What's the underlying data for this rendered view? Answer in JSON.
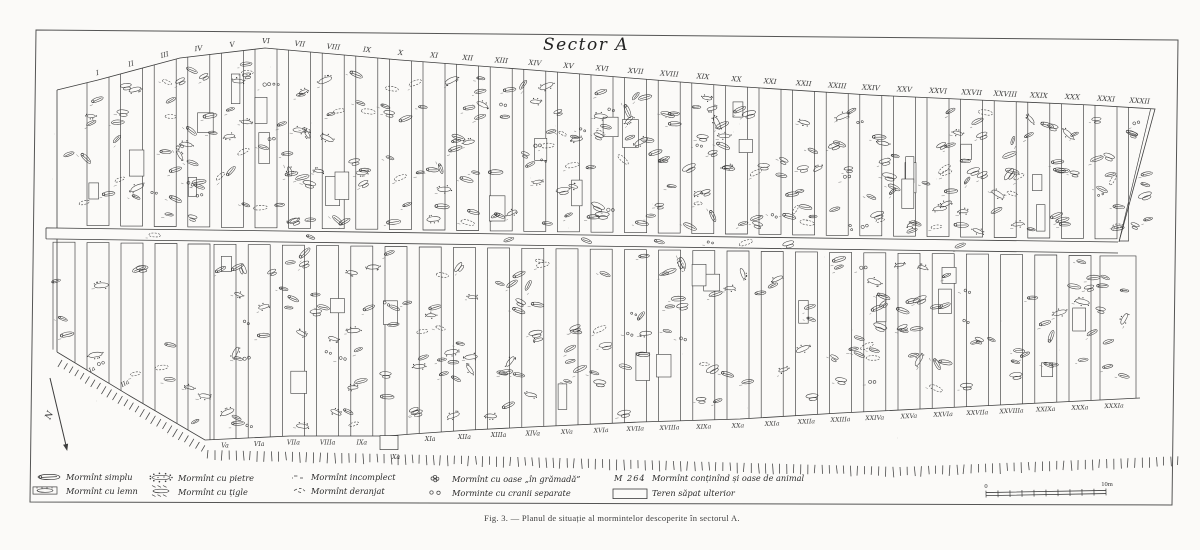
{
  "figure": {
    "title": "Sector A",
    "caption": "Fig. 3. — Planul de situație al mormintelor descoperite în sectorul A.",
    "north_label": "N"
  },
  "scale_bar": {
    "start_label": "0",
    "end_label": "10m"
  },
  "trench_labels": {
    "top": [
      "I",
      "II",
      "III",
      "IV",
      "V",
      "VI",
      "VII",
      "VIII",
      "IX",
      "X",
      "XI",
      "XII",
      "XIII",
      "XIV",
      "XV",
      "XVI",
      "XVII",
      "XVIII",
      "XIX",
      "XX",
      "XXI",
      "XXII",
      "XXIII",
      "XXIV",
      "XXV",
      "XXVI",
      "XXVII",
      "XXVIII",
      "XXIX",
      "XXX",
      "XXXI",
      "XXXII"
    ],
    "bottom_slope": [
      "Ia",
      "IIa"
    ],
    "bottom": [
      "Va",
      "VIa",
      "VIIa",
      "VIIIa",
      "IXa",
      "Xa",
      "XIa",
      "XIIa",
      "XIIIa",
      "XIVa",
      "XVa",
      "XVIa",
      "XVIIa",
      "XVIIIa",
      "XIXa",
      "XXa",
      "XXIa",
      "XXIIa",
      "XXIIIa",
      "XXIVa",
      "XXVa",
      "XXVIa",
      "XXVIIa",
      "XXVIIIa",
      "XXIXa",
      "XXXa",
      "XXXIa"
    ]
  },
  "legend": {
    "items": [
      {
        "id": "mormint-simplu",
        "symbol": "grave-outline",
        "label": "Mormînt simplu"
      },
      {
        "id": "mormint-cu-lemn",
        "symbol": "grave-wood",
        "label": "Mormînt cu lemn"
      },
      {
        "id": "mormint-cu-pietre",
        "symbol": "grave-stones",
        "label": "Mormînt cu pietre"
      },
      {
        "id": "mormint-cu-tigle",
        "symbol": "grave-tiles",
        "label": "Mormînt cu țigle"
      },
      {
        "id": "mormint-incomplect",
        "symbol": "grave-incomplete",
        "label": "Mormînt incomplect"
      },
      {
        "id": "mormint-deranjat",
        "symbol": "grave-disturbed",
        "label": "Mormînt deranjat"
      },
      {
        "id": "mormint-cu-oase-in-gramada",
        "symbol": "bones-heap",
        "label": "Mormînt cu oase „în grămadă”"
      },
      {
        "id": "morminte-cu-cranii-separate",
        "symbol": "skulls-separate",
        "label": "Morminte cu cranii separate"
      },
      {
        "id": "mormint-cu-oase-de-animal",
        "symbol_text": "M 264",
        "label": "Mormînt conținînd și oase de animal"
      },
      {
        "id": "teren-sapat-ulterior",
        "symbol": "rect-outline",
        "label": "Teren săpat ulterior"
      }
    ]
  }
}
